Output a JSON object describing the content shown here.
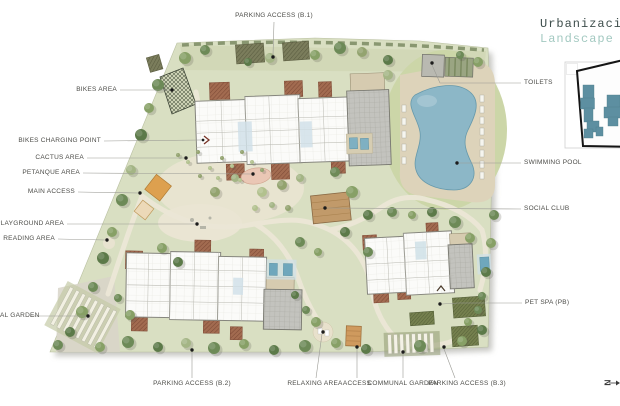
{
  "title": {
    "line1": "Urbanizaci",
    "line2": "Landscape"
  },
  "north_arrow": {
    "label": "N"
  },
  "labels": {
    "parking_b1": "PARKING ACCESS (B.1)",
    "bikes_area": "BIKES AREA",
    "bikes_charging": "BIKES CHARGING POINT",
    "cactus": "CACTUS AREA",
    "petanque": "PETANQUE AREA",
    "main_access": "MAIN ACCESS",
    "playground": "PLAYGROUND AREA",
    "reading": "READING AREA",
    "al_garden": "AL GARDEN",
    "parking_b2": "PARKING ACCESS (B.2)",
    "relaxing": "RELAXING AREA",
    "access": "ACCESS",
    "communal_garden": "COMMUNAL GARDEN",
    "parking_b3": "PARKING ACCESS (B.3)",
    "toilets": "TOILETS",
    "swimming_pool": "SWIMMING POOL",
    "social_club": "SOCIAL CLUB",
    "pet_spa": "PET SPA (PB)"
  },
  "colors": {
    "ground": "#d9dfc2",
    "path": "#ece7d7",
    "pool": "#8cb7c7",
    "terracotta": "#a26b50",
    "roof": "#c3c3be",
    "building": "#fbfbf9",
    "social_club": "#c19a6a",
    "access_orange": "#dda04f",
    "petanque": "#eac7b5",
    "inset_building": "#5d8fa1",
    "title_primary": "#3e4e4c",
    "title_accent": "#a3c9c1",
    "label_text": "#4c4c48"
  }
}
